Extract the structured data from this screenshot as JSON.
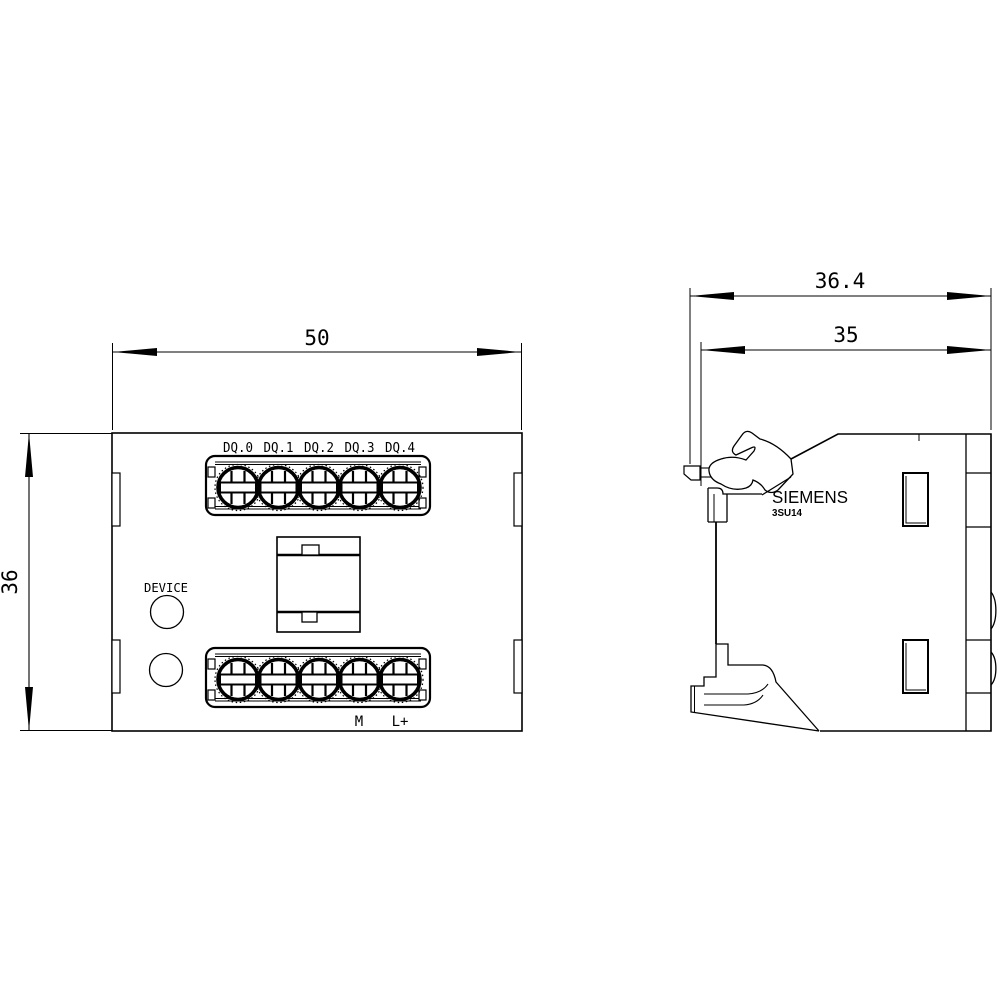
{
  "drawing": {
    "type": "dimensional-drawing",
    "background_color": "#ffffff",
    "line_color": "#000000",
    "front_view": {
      "width_dim": "50",
      "height_dim": "36",
      "terminal_labels": [
        "DQ.0",
        "DQ.1",
        "DQ.2",
        "DQ.3",
        "DQ.4"
      ],
      "bottom_labels": {
        "m": "M",
        "lplus": "L+"
      },
      "device_label": "DEVICE"
    },
    "side_view": {
      "overall_depth_dim": "36.4",
      "body_depth_dim": "35",
      "brand": "SIEMENS",
      "model": "3SU14"
    }
  }
}
